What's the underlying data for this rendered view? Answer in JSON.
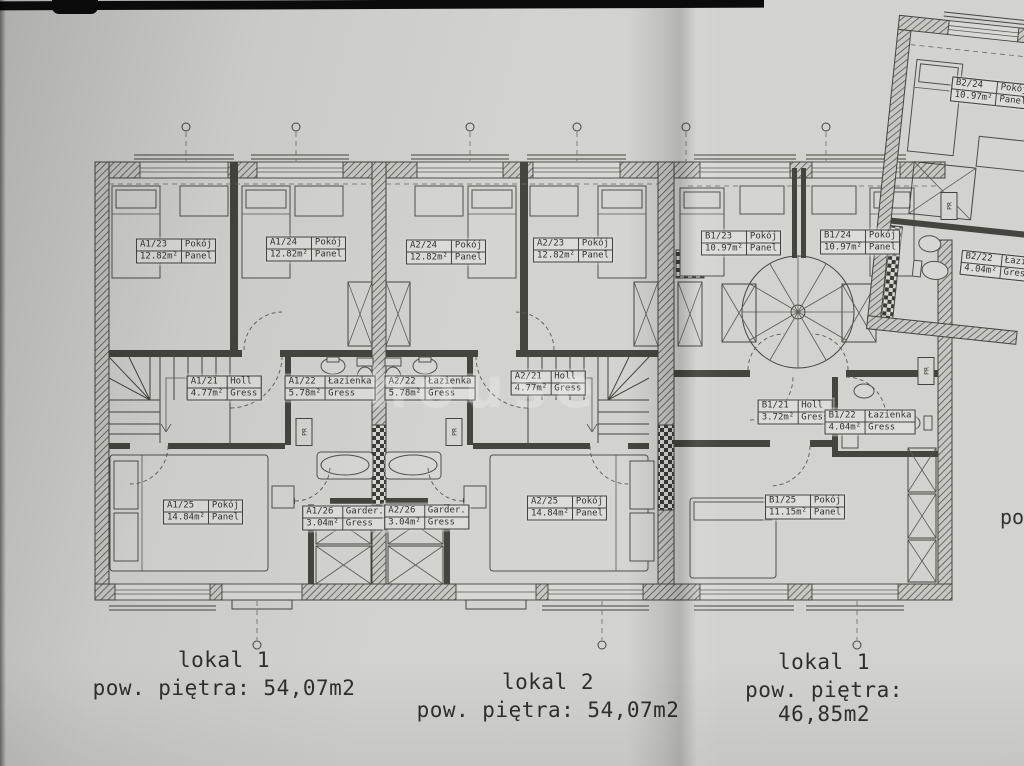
{
  "colors": {
    "paper": "#d2d3cf",
    "line": "#45453f",
    "label_bg": "#dcddd8"
  },
  "rooms": [
    {
      "id": "A1/23",
      "name": "Pokój",
      "area": "12.82m²",
      "floor": "Panel",
      "x": 176,
      "y": 251
    },
    {
      "id": "A1/24",
      "name": "Pokój",
      "area": "12.82m²",
      "floor": "Panel",
      "x": 306,
      "y": 249
    },
    {
      "id": "A2/24",
      "name": "Pokój",
      "area": "12.82m²",
      "floor": "Panel",
      "x": 446,
      "y": 252
    },
    {
      "id": "A2/23",
      "name": "Pokój",
      "area": "12.82m²",
      "floor": "Panel",
      "x": 573,
      "y": 250
    },
    {
      "id": "B1/23",
      "name": "Pokój",
      "area": "10.97m²",
      "floor": "Panel",
      "x": 741,
      "y": 243
    },
    {
      "id": "B1/24",
      "name": "Pokój",
      "area": "10.97m²",
      "floor": "Panel",
      "x": 860,
      "y": 242
    },
    {
      "id": "A1/21",
      "name": "Holl",
      "area": "4.77m²",
      "floor": "Gress",
      "x": 224,
      "y": 388
    },
    {
      "id": "A1/22",
      "name": "Łazienka",
      "area": "5.78m²",
      "floor": "Gress",
      "x": 330,
      "y": 388
    },
    {
      "id": "A2/22",
      "name": "Łazienka",
      "area": "5.78m²",
      "floor": "Gress",
      "x": 430,
      "y": 388
    },
    {
      "id": "A2/21",
      "name": "Holl",
      "area": "4.77m²",
      "floor": "Gress",
      "x": 548,
      "y": 383
    },
    {
      "id": "B1/21",
      "name": "Holl",
      "area": "3.72m²",
      "floor": "Gress",
      "x": 795,
      "y": 412
    },
    {
      "id": "B1/22",
      "name": "Łazienka",
      "area": "4.04m²",
      "floor": "Gress",
      "x": 870,
      "y": 422
    },
    {
      "id": "A1/25",
      "name": "Pokój",
      "area": "14.84m²",
      "floor": "Panel",
      "x": 203,
      "y": 512
    },
    {
      "id": "A1/26",
      "name": "Garder.",
      "area": "3.04m²",
      "floor": "Gress",
      "x": 345,
      "y": 518
    },
    {
      "id": "A2/26",
      "name": "Garder.",
      "area": "3.04m²",
      "floor": "Gress",
      "x": 427,
      "y": 517
    },
    {
      "id": "A2/25",
      "name": "Pokój",
      "area": "14.84m²",
      "floor": "Panel",
      "x": 567,
      "y": 508
    },
    {
      "id": "B1/25",
      "name": "Pokój",
      "area": "11.15m²",
      "floor": "Panel",
      "x": 805,
      "y": 507
    },
    {
      "id": "B2/24",
      "name": "Pokój",
      "area": "10.97m²",
      "floor": "Panel",
      "x": 991,
      "y": 93,
      "rot": 6
    },
    {
      "id": "B2/22",
      "name": "Łazienka",
      "area": "4.04m²",
      "floor": "Gress",
      "x": 1006,
      "y": 267,
      "rot": 6
    }
  ],
  "shafts": [
    {
      "x": 304,
      "y": 432
    },
    {
      "x": 454,
      "y": 432
    },
    {
      "x": 926,
      "y": 371
    },
    {
      "x": 949,
      "y": 206
    }
  ],
  "shaft_label": "PR",
  "totals": [
    {
      "name": "lokal 1",
      "area": "pow. piętra: 54,07m2",
      "x": 224,
      "y": 648
    },
    {
      "name": "lokal 2",
      "area": "pow. piętra: 54,07m2",
      "x": 548,
      "y": 670
    },
    {
      "name": "lokal 1",
      "area": "pow. piętra: 46,85m2",
      "x": 824,
      "y": 650
    }
  ],
  "watermark": "house",
  "edge_text": "po"
}
